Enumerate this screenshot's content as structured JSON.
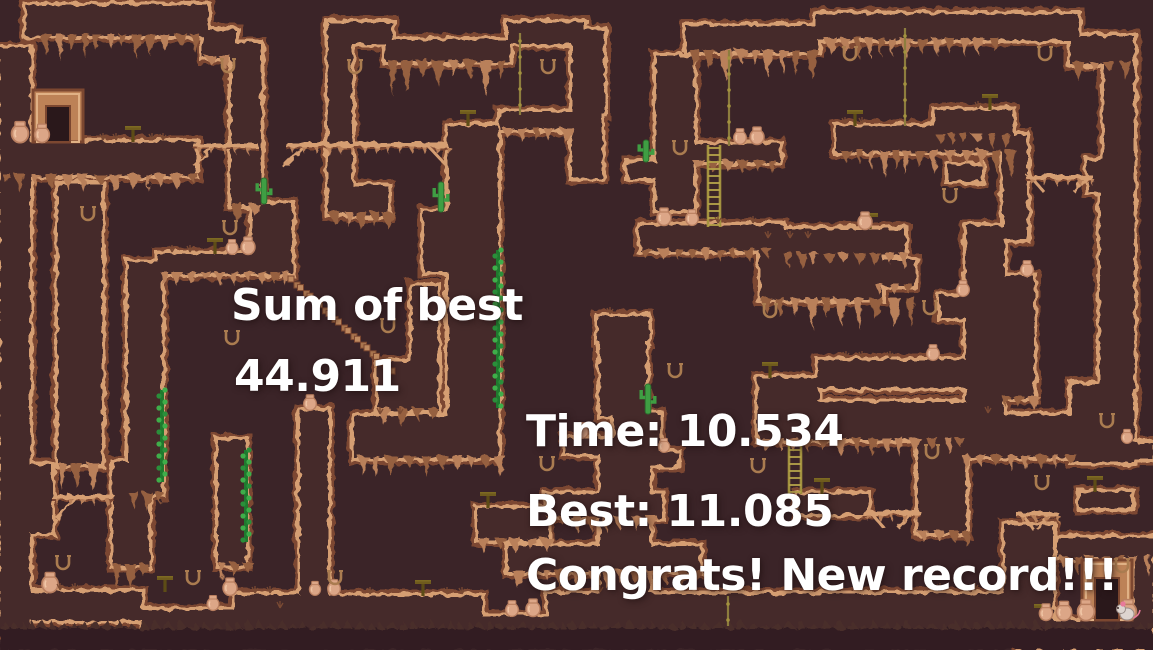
{
  "hud": {
    "sum_of_best": {
      "label": "Sum of best",
      "value": "44.911"
    },
    "run": {
      "time": "Time: 10.534",
      "best": "Best: 11.085",
      "congrats": "Congrats! New record!!!"
    }
  },
  "palette": {
    "background": "#3b2428",
    "terrain_fill": "#45292c",
    "edge_light": "#d59e72",
    "edge_dark": "#7c4730",
    "drip": "#b9805a",
    "base": "#311f20",
    "base_teeth": "#4a2e2b",
    "text": "#ffffff",
    "cactus": "#3f9e43",
    "cactus_dark": "#2c6e2e",
    "ivy": "#3fae4a",
    "ivy_dark": "#1f7a2e",
    "rope": "#8d7d3e",
    "ladder": "#a3923f",
    "table_top": "#6f5b1d",
    "table_stem": "#5d4c16",
    "pot": "#dca687",
    "pot_shade": "#b97f60",
    "horseshoe": "#aa7c50",
    "door_frame": "#bd8257",
    "door_opening": "#2a181b",
    "grass": "#7a4a33",
    "trail": "#c08a60",
    "player_body": "#ddd4cf",
    "player_accent": "#e87a9a"
  },
  "map": {
    "blocks": [
      [
        26,
        5,
        182,
        31
      ],
      [
        203,
        30,
        33,
        28
      ],
      [
        231,
        44,
        30,
        162
      ],
      [
        0,
        48,
        30,
        584
      ],
      [
        0,
        142,
        196,
        34
      ],
      [
        28,
        465,
        24,
        68
      ],
      [
        58,
        184,
        44,
        281
      ],
      [
        113,
        462,
        36,
        104
      ],
      [
        30,
        592,
        112,
        28
      ],
      [
        142,
        610,
        92,
        20
      ],
      [
        234,
        595,
        100,
        37
      ],
      [
        158,
        254,
        106,
        20
      ],
      [
        128,
        262,
        34,
        232
      ],
      [
        252,
        204,
        40,
        70
      ],
      [
        218,
        440,
        28,
        125
      ],
      [
        300,
        410,
        28,
        220
      ],
      [
        378,
        362,
        40,
        48
      ],
      [
        412,
        286,
        26,
        124
      ],
      [
        328,
        22,
        24,
        192
      ],
      [
        352,
        186,
        36,
        30
      ],
      [
        330,
        22,
        62,
        22
      ],
      [
        386,
        40,
        124,
        22
      ],
      [
        508,
        22,
        76,
        22
      ],
      [
        572,
        30,
        32,
        84
      ],
      [
        500,
        112,
        80,
        18
      ],
      [
        448,
        126,
        50,
        314
      ],
      [
        354,
        416,
        144,
        42
      ],
      [
        572,
        114,
        30,
        64
      ],
      [
        424,
        212,
        40,
        60
      ],
      [
        478,
        508,
        70,
        32
      ],
      [
        546,
        494,
        116,
        24
      ],
      [
        300,
        596,
        182,
        36
      ],
      [
        482,
        616,
        66,
        16
      ],
      [
        508,
        546,
        192,
        26
      ],
      [
        548,
        594,
        472,
        38
      ],
      [
        565,
        438,
        60,
        16
      ],
      [
        798,
        494,
        70,
        20
      ],
      [
        686,
        26,
        132,
        26
      ],
      [
        816,
        14,
        262,
        26
      ],
      [
        1070,
        36,
        64,
        28
      ],
      [
        1104,
        60,
        30,
        106
      ],
      [
        1088,
        160,
        46,
        32
      ],
      [
        1100,
        190,
        34,
        196
      ],
      [
        1072,
        384,
        62,
        78
      ],
      [
        1080,
        492,
        52,
        16
      ],
      [
        1108,
        443,
        45,
        16
      ],
      [
        656,
        56,
        38,
        154
      ],
      [
        692,
        144,
        88,
        18
      ],
      [
        628,
        162,
        34,
        16
      ],
      [
        598,
        316,
        50,
        26
      ],
      [
        600,
        340,
        46,
        76
      ],
      [
        614,
        414,
        46,
        38
      ],
      [
        600,
        450,
        50,
        146
      ],
      [
        650,
        452,
        28,
        14
      ],
      [
        640,
        225,
        143,
        26
      ],
      [
        783,
        229,
        122,
        26
      ],
      [
        836,
        126,
        174,
        26
      ],
      [
        935,
        110,
        78,
        26
      ],
      [
        948,
        165,
        34,
        16
      ],
      [
        760,
        240,
        122,
        60
      ],
      [
        875,
        260,
        40,
        26
      ],
      [
        818,
        360,
        148,
        28
      ],
      [
        758,
        378,
        60,
        26
      ],
      [
        758,
        402,
        208,
        38
      ],
      [
        966,
        226,
        38,
        208
      ],
      [
        1002,
        276,
        32,
        122
      ],
      [
        940,
        296,
        64,
        22
      ],
      [
        962,
        415,
        110,
        42
      ],
      [
        1003,
        135,
        24,
        105
      ],
      [
        918,
        427,
        48,
        106
      ],
      [
        1005,
        525,
        48,
        100
      ],
      [
        1058,
        538,
        95,
        20
      ],
      [
        1020,
        620,
        133,
        30
      ],
      [
        1134,
        556,
        19,
        66
      ]
    ],
    "drips": [
      [
        40,
        36,
        160,
        22
      ],
      [
        205,
        58,
        28,
        14
      ],
      [
        2,
        176,
        190,
        15
      ],
      [
        231,
        206,
        30,
        16
      ],
      [
        160,
        274,
        130,
        14
      ],
      [
        388,
        62,
        118,
        32
      ],
      [
        502,
        130,
        74,
        12
      ],
      [
        328,
        214,
        60,
        15
      ],
      [
        690,
        52,
        124,
        24
      ],
      [
        824,
        40,
        180,
        16
      ],
      [
        1072,
        64,
        56,
        14
      ],
      [
        840,
        152,
        166,
        22
      ],
      [
        935,
        136,
        76,
        11
      ],
      [
        692,
        162,
        86,
        11
      ],
      [
        760,
        300,
        150,
        24
      ],
      [
        875,
        286,
        38,
        11
      ],
      [
        358,
        458,
        136,
        18
      ],
      [
        760,
        440,
        200,
        16
      ],
      [
        512,
        572,
        184,
        16
      ],
      [
        1060,
        558,
        88,
        16
      ],
      [
        58,
        465,
        44,
        28
      ],
      [
        113,
        566,
        36,
        20
      ],
      [
        546,
        518,
        112,
        13
      ],
      [
        478,
        540,
        66,
        11
      ],
      [
        962,
        457,
        104,
        14
      ],
      [
        640,
        251,
        136,
        11
      ],
      [
        783,
        255,
        116,
        12
      ],
      [
        128,
        494,
        32,
        16
      ],
      [
        218,
        565,
        28,
        15
      ],
      [
        378,
        410,
        60,
        16
      ],
      [
        1002,
        398,
        30,
        11
      ],
      [
        918,
        533,
        46,
        12
      ]
    ],
    "base_strip": [
      0,
      628,
      1153,
      22
    ],
    "bridges": [
      {
        "x": 194,
        "y": 146,
        "w": 64,
        "struts": [
          [
            214,
            146,
            194,
            166
          ]
        ]
      },
      {
        "x": 286,
        "y": 145,
        "w": 162,
        "struts": [
          [
            306,
            146,
            284,
            168
          ],
          [
            428,
            146,
            446,
            165
          ]
        ]
      },
      {
        "x": 52,
        "y": 497,
        "w": 62,
        "struts": [
          [
            78,
            497,
            56,
            518
          ]
        ]
      },
      {
        "x": 1026,
        "y": 177,
        "w": 66,
        "struts": [
          [
            1032,
            178,
            1044,
            192
          ],
          [
            1086,
            178,
            1074,
            192
          ]
        ]
      },
      {
        "x": 862,
        "y": 513,
        "w": 58,
        "struts": [
          [
            872,
            514,
            884,
            528
          ],
          [
            910,
            514,
            898,
            528
          ]
        ]
      },
      {
        "x": 1016,
        "y": 514,
        "w": 42,
        "struts": [
          [
            1022,
            514,
            1034,
            530
          ],
          [
            1050,
            514,
            1038,
            530
          ]
        ]
      }
    ],
    "ropes": [
      [
        520,
        33,
        82
      ],
      [
        729,
        50,
        96
      ],
      [
        905,
        28,
        98
      ],
      [
        728,
        596,
        30
      ]
    ],
    "ladders": [
      [
        714,
        145,
        82
      ],
      [
        795,
        440,
        54
      ]
    ],
    "ivy": [
      [
        498,
        250,
        158
      ],
      [
        162,
        390,
        92
      ],
      [
        246,
        450,
        92
      ]
    ],
    "cacti": [
      [
        264,
        204,
        26
      ],
      [
        441,
        212,
        30
      ],
      [
        646,
        162,
        22
      ],
      [
        648,
        414,
        30
      ]
    ],
    "pots": [
      [
        20,
        142,
        1.2
      ],
      [
        42,
        142,
        1.05
      ],
      [
        232,
        254,
        0.85
      ],
      [
        248,
        254,
        1.0
      ],
      [
        310,
        410,
        0.9
      ],
      [
        50,
        592,
        1.15
      ],
      [
        230,
        595,
        1.0
      ],
      [
        213,
        610,
        0.85
      ],
      [
        315,
        595,
        0.8
      ],
      [
        334,
        595,
        0.9
      ],
      [
        512,
        616,
        0.9
      ],
      [
        533,
        616,
        1.0
      ],
      [
        582,
        438,
        0.9
      ],
      [
        664,
        452,
        0.8
      ],
      [
        740,
        144,
        0.9
      ],
      [
        757,
        144,
        1.0
      ],
      [
        664,
        225,
        1.0
      ],
      [
        692,
        225,
        0.9
      ],
      [
        865,
        229,
        1.0
      ],
      [
        963,
        296,
        0.9
      ],
      [
        1027,
        276,
        0.9
      ],
      [
        933,
        360,
        0.9
      ],
      [
        1127,
        443,
        0.8
      ],
      [
        1046,
        620,
        0.95
      ],
      [
        1064,
        620,
        1.1
      ],
      [
        1086,
        620,
        1.2
      ],
      [
        1128,
        620,
        1.2
      ]
    ],
    "horseshoes": [
      [
        228,
        66
      ],
      [
        88,
        214
      ],
      [
        230,
        228
      ],
      [
        232,
        338
      ],
      [
        388,
        326
      ],
      [
        355,
        67
      ],
      [
        548,
        67
      ],
      [
        680,
        148
      ],
      [
        850,
        54
      ],
      [
        1045,
        54
      ],
      [
        950,
        196
      ],
      [
        675,
        371
      ],
      [
        770,
        311
      ],
      [
        930,
        308
      ],
      [
        547,
        464
      ],
      [
        758,
        466
      ],
      [
        932,
        452
      ],
      [
        1107,
        421
      ],
      [
        1042,
        483
      ],
      [
        63,
        563
      ],
      [
        193,
        578
      ],
      [
        335,
        578
      ],
      [
        1122,
        566
      ]
    ],
    "tables": [
      [
        133,
        142
      ],
      [
        215,
        254
      ],
      [
        468,
        126
      ],
      [
        990,
        110
      ],
      [
        855,
        126
      ],
      [
        870,
        229
      ],
      [
        770,
        378
      ],
      [
        822,
        494
      ],
      [
        1095,
        492
      ],
      [
        488,
        508
      ],
      [
        423,
        596
      ],
      [
        165,
        592
      ],
      [
        1042,
        620
      ]
    ],
    "grass": [
      [
        103,
        140
      ],
      [
        116,
        140
      ],
      [
        152,
        140
      ],
      [
        163,
        140
      ],
      [
        172,
        252
      ],
      [
        190,
        252
      ],
      [
        60,
        590
      ],
      [
        75,
        590
      ],
      [
        280,
        608
      ],
      [
        255,
        593
      ],
      [
        270,
        593
      ],
      [
        370,
        594
      ],
      [
        447,
        594
      ],
      [
        462,
        594
      ],
      [
        565,
        592
      ],
      [
        600,
        592
      ],
      [
        660,
        592
      ],
      [
        940,
        590
      ],
      [
        975,
        590
      ],
      [
        718,
        223
      ],
      [
        753,
        223
      ],
      [
        845,
        124
      ],
      [
        862,
        124
      ],
      [
        978,
        108
      ],
      [
        846,
        358
      ],
      [
        862,
        358
      ],
      [
        890,
        358
      ],
      [
        768,
        238
      ],
      [
        790,
        238
      ],
      [
        808,
        238
      ],
      [
        988,
        413
      ],
      [
        380,
        414
      ],
      [
        400,
        414
      ],
      [
        610,
        314
      ]
    ],
    "trail": {
      "x": 288,
      "y": 276,
      "steps": 11,
      "dx": 9.5,
      "dy": 8.6,
      "size": 6
    },
    "doors": [
      {
        "frame": [
          33,
          90,
          50,
          52
        ],
        "opening": [
          46,
          106,
          24,
          36
        ]
      },
      {
        "frame": [
          1082,
          560,
          50,
          60
        ],
        "opening": [
          1095,
          578,
          24,
          42
        ]
      }
    ],
    "player": {
      "x": 1127,
      "y": 620
    }
  }
}
